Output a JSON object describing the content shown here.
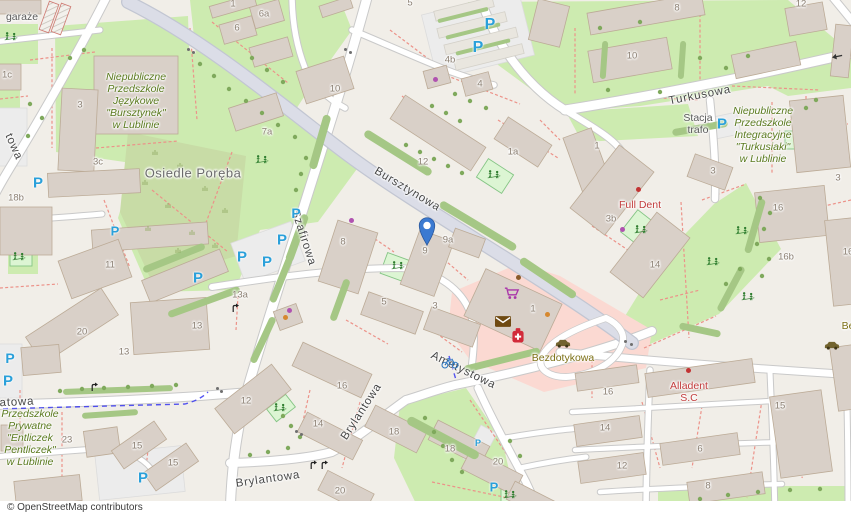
{
  "attribution": "© OpenStreetMap contributors",
  "marker": {
    "x": 427,
    "y": 246,
    "color": "#3b7ad1"
  },
  "colors": {
    "parking_blue": "#2aa0da",
    "poi_purple": "#b052b0",
    "poi_orange": "#d6882f",
    "poi_red": "#c23333",
    "poi_brown": "#8a5a2a",
    "gate_gray": "#6f6f6f"
  },
  "streets": [
    {
      "t": "Szafirowa",
      "x": 303,
      "y": 238,
      "r": 72
    },
    {
      "t": "Bursztynowa",
      "x": 407,
      "y": 190,
      "r": 31
    },
    {
      "t": "Turkusowa",
      "x": 700,
      "y": 96,
      "r": -11
    },
    {
      "t": "Ametystowa",
      "x": 463,
      "y": 371,
      "r": 26
    },
    {
      "t": "Brylantowa",
      "x": 362,
      "y": 412,
      "r": -57
    },
    {
      "t": "Brylantowa",
      "x": 268,
      "y": 480,
      "r": -8
    },
    {
      "t": "towa",
      "x": 13,
      "y": 147,
      "r": 66
    },
    {
      "t": "atowa",
      "x": 17,
      "y": 403,
      "r": -3
    }
  ],
  "places": [
    {
      "t": "Osiedle Poręba",
      "x": 193,
      "y": 174
    }
  ],
  "pois": [
    {
      "n": "kindergarten-bursztynek",
      "cls": "edu",
      "x": 136,
      "y": 101,
      "lines": [
        "Niepubliczne",
        "Przedszkole",
        "Językowe",
        "\"Bursztynek\"",
        "w Lublinie"
      ]
    },
    {
      "n": "kindergarten-turkusiaki",
      "cls": "edu",
      "x": 763,
      "y": 135,
      "lines": [
        "Niepubliczne",
        "Przedszkole",
        "Integracyjne",
        "\"Turkusiaki\"",
        "w Lublinie"
      ]
    },
    {
      "n": "kindergarten-entliczek",
      "cls": "edu",
      "x": 30,
      "y": 438,
      "lines": [
        "Przedszkole",
        "Prywatne",
        "\"Entliczek",
        "Pentliczek\"",
        "w Lublinie"
      ]
    },
    {
      "n": "dentist-full-dent",
      "cls": "health",
      "x": 640,
      "y": 205,
      "lines": [
        "Full Dent"
      ]
    },
    {
      "n": "dentist-alladent",
      "cls": "health",
      "x": 689,
      "y": 392,
      "lines": [
        "Alladent",
        "S.C"
      ]
    },
    {
      "n": "car-wash-bezdotykowa",
      "cls": "amenity",
      "x": 563,
      "y": 358,
      "lines": [
        "Bezdotykowa"
      ]
    },
    {
      "n": "garages-label",
      "cls": "gray2",
      "x": 22,
      "y": 17,
      "lines": [
        "garaże"
      ]
    },
    {
      "n": "substation-stacja-trafo",
      "cls": "gray2",
      "x": 698,
      "y": 124,
      "lines": [
        "Stacja",
        "trafo"
      ]
    },
    {
      "n": "truncated-poi-label",
      "cls": "amenity",
      "x": 848,
      "y": 326,
      "lines": [
        "Be"
      ]
    }
  ],
  "house_numbers": [
    [
      "1",
      233,
      5
    ],
    [
      "6a",
      264,
      15
    ],
    [
      "6",
      237,
      29
    ],
    [
      "5",
      410,
      4
    ],
    [
      "10",
      335,
      90
    ],
    [
      "1c",
      7,
      76
    ],
    [
      "3",
      80,
      106
    ],
    [
      "7a",
      267,
      133
    ],
    [
      "3c",
      98,
      163
    ],
    [
      "18b",
      16,
      199
    ],
    [
      "11",
      110,
      266
    ],
    [
      "13a",
      240,
      296
    ],
    [
      "13",
      197,
      327
    ],
    [
      "13",
      124,
      353
    ],
    [
      "20",
      82,
      333
    ],
    [
      "23",
      67,
      441
    ],
    [
      "15",
      137,
      447
    ],
    [
      "15",
      173,
      464
    ],
    [
      "12",
      246,
      402
    ],
    [
      "8",
      343,
      243
    ],
    [
      "9",
      425,
      252
    ],
    [
      "9a",
      448,
      241
    ],
    [
      "5",
      384,
      303
    ],
    [
      "3",
      435,
      307
    ],
    [
      "12",
      423,
      163
    ],
    [
      "1a",
      513,
      153
    ],
    [
      "4b",
      450,
      61
    ],
    [
      "4",
      480,
      85
    ],
    [
      "10",
      632,
      57
    ],
    [
      "8",
      677,
      9
    ],
    [
      "12",
      801,
      5
    ],
    [
      "1",
      597,
      147
    ],
    [
      "3",
      713,
      172
    ],
    [
      "3b",
      611,
      220
    ],
    [
      "14",
      655,
      266
    ],
    [
      "3",
      838,
      179
    ],
    [
      "16",
      778,
      209
    ],
    [
      "16b",
      786,
      258
    ],
    [
      "16",
      848,
      253
    ],
    [
      "16",
      342,
      387
    ],
    [
      "14",
      318,
      425
    ],
    [
      "18",
      394,
      433
    ],
    [
      "18",
      450,
      450
    ],
    [
      "20",
      498,
      463
    ],
    [
      "20",
      340,
      492
    ],
    [
      "16",
      608,
      393
    ],
    [
      "14",
      605,
      429
    ],
    [
      "12",
      622,
      467
    ],
    [
      "6",
      700,
      450
    ],
    [
      "8",
      708,
      487
    ],
    [
      "15",
      780,
      407
    ],
    [
      "1",
      533,
      310
    ]
  ],
  "icons": {
    "parking_glyph": "P",
    "parking": [
      [
        38,
        183,
        15
      ],
      [
        115,
        231,
        13
      ],
      [
        198,
        278,
        15
      ],
      [
        242,
        257,
        15
      ],
      [
        267,
        262,
        15
      ],
      [
        282,
        240,
        15
      ],
      [
        296,
        213,
        14
      ],
      [
        490,
        25,
        16
      ],
      [
        478,
        48,
        16
      ],
      [
        722,
        124,
        15
      ],
      [
        10,
        358,
        14
      ],
      [
        8,
        381,
        15
      ],
      [
        143,
        478,
        15
      ],
      [
        494,
        487,
        13
      ],
      [
        478,
        443,
        9
      ]
    ],
    "playground": [
      [
        11,
        37
      ],
      [
        262,
        160
      ],
      [
        19,
        257
      ],
      [
        398,
        266
      ],
      [
        494,
        175
      ],
      [
        641,
        230
      ],
      [
        742,
        231
      ],
      [
        713,
        262
      ],
      [
        748,
        297
      ],
      [
        280,
        408
      ],
      [
        510,
        495
      ]
    ],
    "cart": [
      512,
      296
    ],
    "mail": [
      503,
      323
    ],
    "pharmacy": [
      518,
      338
    ],
    "bike": [
      450,
      365
    ],
    "car": [
      [
        563,
        344
      ],
      [
        832,
        346
      ]
    ],
    "oneway": [
      [
        837,
        57,
        168
      ]
    ],
    "turn": [
      [
        236,
        309
      ],
      [
        95,
        388
      ],
      [
        314,
        466
      ],
      [
        325,
        466
      ]
    ]
  },
  "dots": {
    "purple": [
      [
        435,
        79
      ],
      [
        351,
        220
      ],
      [
        622,
        229
      ],
      [
        289,
        310
      ]
    ],
    "orange": [
      [
        285,
        317
      ],
      [
        547,
        314
      ]
    ],
    "red": [
      [
        638,
        189
      ],
      [
        688,
        370
      ]
    ],
    "brown": [
      [
        518,
        277
      ]
    ],
    "gate": [
      [
        188,
        49
      ],
      [
        193,
        52
      ],
      [
        345,
        49
      ],
      [
        350,
        52
      ],
      [
        625,
        341
      ],
      [
        631,
        344
      ],
      [
        296,
        431
      ],
      [
        301,
        434
      ],
      [
        217,
        388
      ],
      [
        221,
        391
      ]
    ]
  }
}
